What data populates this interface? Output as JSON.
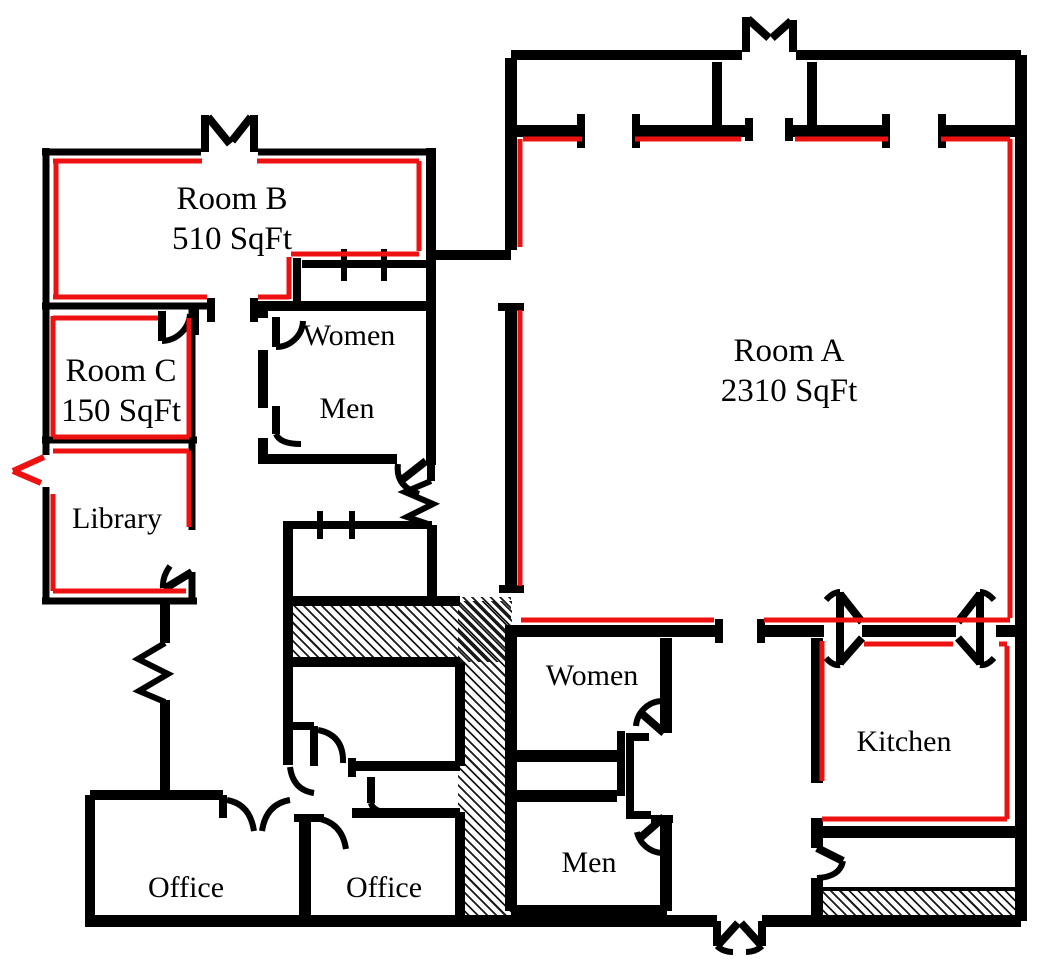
{
  "floorplan": {
    "background": "#ffffff",
    "wall_color": "#000000",
    "highlight_color": "#ee1111",
    "rooms": [
      {
        "id": "room-a",
        "name": "Room A",
        "area": "2310 SqFt"
      },
      {
        "id": "room-b",
        "name": "Room B",
        "area": "510 SqFt"
      },
      {
        "id": "room-c",
        "name": "Room C",
        "area": "150 SqFt"
      },
      {
        "id": "library",
        "name": "Library"
      },
      {
        "id": "women-upper",
        "name": "Women"
      },
      {
        "id": "men-upper",
        "name": "Men"
      },
      {
        "id": "women-lower",
        "name": "Women"
      },
      {
        "id": "men-lower",
        "name": "Men"
      },
      {
        "id": "kitchen",
        "name": "Kitchen"
      },
      {
        "id": "office-left",
        "name": "Office"
      },
      {
        "id": "office-right",
        "name": "Office"
      }
    ]
  }
}
